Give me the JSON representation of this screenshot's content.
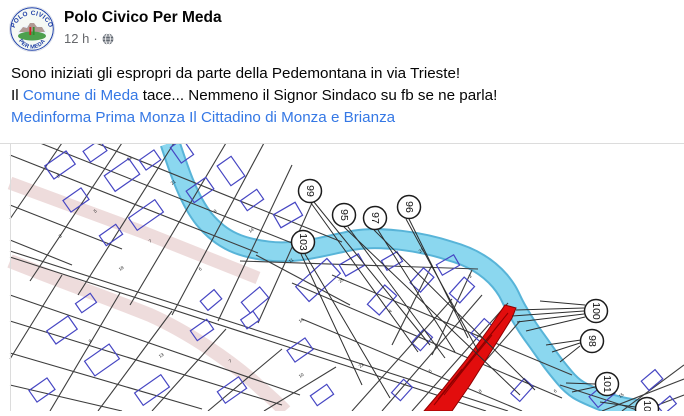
{
  "colors": {
    "text": "#050505",
    "secondary_text": "#65676b",
    "link": "#3578e5",
    "river": "#8bd7ef",
    "river_edge": "#58b4d8",
    "road": "#eedcdc",
    "parcel_line": "#3d3d3d",
    "building": "#4646c3",
    "red_zone": "#e20d0d",
    "red_zone_dark": "#8f0000",
    "marker_stroke": "#1c1c1c",
    "image_border": "#dcdcdc"
  },
  "post": {
    "author": "Polo Civico Per Meda",
    "avatar": {
      "top_text": "POLO CIVICO",
      "bottom_text": "PER MEDA"
    },
    "meta": {
      "time": "12 h",
      "sep": "·",
      "privacy": "globe"
    },
    "body": [
      [
        {
          "t": "Sono iniziati gli espropri da parte della Pedemontana in via Trieste!",
          "link": false
        }
      ],
      [
        {
          "t": "Il ",
          "link": false
        },
        {
          "t": "Comune di Meda",
          "link": true
        },
        {
          "t": " tace... Nemmeno il Signor Sindaco su fb se ne parla!",
          "link": false
        }
      ],
      [
        {
          "t": "Medinforma",
          "link": true
        },
        {
          "t": " ",
          "link": false
        },
        {
          "t": "Prima Monza",
          "link": true
        },
        {
          "t": " ",
          "link": false
        },
        {
          "t": "Il Cittadino di Monza e Brianza",
          "link": true
        }
      ]
    ]
  },
  "map": {
    "river": {
      "d": "M170,0 C178,24 188,56 204,76 C222,98 242,105 268,108 C300,112 330,101 355,97 C380,93 420,98 450,108 C472,114 488,124 500,138 C510,150 510,155 517,167 C528,186 530,188 540,202 C552,219 554,222 565,235 C576,248 584,250 600,257 C620,265 635,266 648,268"
    },
    "roads": [
      {
        "d": "M10,40 L140,88 L258,135",
        "w": 13
      },
      {
        "d": "M10,118 C60,138 110,156 150,172 C190,190 230,218 255,240 C268,252 278,260 285,268",
        "w": 14
      }
    ],
    "parcel_lines": [
      "M10,12 L258,110",
      "M40,0 L302,104",
      "M96,0 L342,99",
      "M10,62 L122,106",
      "M10,97 L72,122",
      "M122,0 L30,138",
      "M174,0 L78,152",
      "M226,0 L130,162",
      "M264,0 L172,172",
      "M62,0 L10,76",
      "M292,22 L218,178",
      "M320,42 L258,180",
      "M10,108 L508,268",
      "M10,114 L486,268",
      "M10,152 L300,252",
      "M10,178 L282,262",
      "M10,210 L202,266",
      "M10,242 L122,268",
      "M62,132 L10,216",
      "M120,150 L50,268",
      "M172,168 L98,268",
      "M226,186 L152,268",
      "M282,206 L208,268",
      "M336,224 L264,268",
      "M382,268 L482,152",
      "M352,268 L452,156",
      "M412,268 L508,160",
      "M442,268 L520,178",
      "M292,140 L562,255",
      "M302,176 L522,268",
      "M332,132 L572,232",
      "M256,112 L350,162",
      "M432,122 L392,202",
      "M472,127 L432,212",
      "M240,118 L478,126",
      "M622,268 L684,222",
      "M602,268 L684,236",
      "M642,268 L684,252",
      "M560,242 L640,268"
    ],
    "buildings": [
      [
        60,
        22,
        26,
        16,
        -35
      ],
      [
        95,
        8,
        20,
        13,
        -35
      ],
      [
        122,
        32,
        30,
        19,
        -35
      ],
      [
        76,
        57,
        22,
        14,
        -35
      ],
      [
        150,
        17,
        18,
        12,
        -35
      ],
      [
        182,
        8,
        15,
        19,
        -35
      ],
      [
        146,
        72,
        32,
        15,
        -35
      ],
      [
        111,
        92,
        20,
        12,
        -35
      ],
      [
        200,
        47,
        24,
        14,
        -35
      ],
      [
        231,
        28,
        17,
        24,
        -35
      ],
      [
        252,
        57,
        20,
        12,
        -35
      ],
      [
        288,
        72,
        25,
        15,
        -30
      ],
      [
        255,
        157,
        24,
        14,
        -40
      ],
      [
        211,
        157,
        18,
        12,
        -40
      ],
      [
        318,
        137,
        42,
        20,
        -42
      ],
      [
        86,
        160,
        18,
        11,
        -35
      ],
      [
        62,
        187,
        26,
        16,
        -35
      ],
      [
        102,
        217,
        30,
        18,
        -35
      ],
      [
        42,
        247,
        22,
        14,
        -35
      ],
      [
        152,
        247,
        32,
        15,
        -35
      ],
      [
        202,
        187,
        20,
        12,
        -35
      ],
      [
        250,
        177,
        15,
        11,
        -35
      ],
      [
        300,
        207,
        22,
        14,
        -35
      ],
      [
        232,
        247,
        26,
        14,
        -35
      ],
      [
        322,
        252,
        20,
        12,
        -35
      ],
      [
        382,
        157,
        26,
        16,
        -48
      ],
      [
        422,
        137,
        20,
        14,
        -48
      ],
      [
        462,
        147,
        22,
        14,
        -48
      ],
      [
        482,
        187,
        20,
        12,
        -48
      ],
      [
        422,
        197,
        18,
        12,
        -48
      ],
      [
        462,
        237,
        24,
        14,
        -48
      ],
      [
        402,
        247,
        18,
        12,
        -48
      ],
      [
        522,
        247,
        20,
        12,
        -48
      ],
      [
        352,
        122,
        22,
        13,
        -30
      ],
      [
        392,
        118,
        18,
        11,
        -30
      ],
      [
        448,
        122,
        20,
        12,
        -30
      ],
      [
        602,
        252,
        22,
        14,
        -40
      ],
      [
        652,
        237,
        18,
        12,
        -40
      ],
      [
        667,
        262,
        16,
        10,
        -40
      ]
    ],
    "red_zone": {
      "points": "424,268 452,268 470,242 492,207 512,175 516,165 505,162 488,187 466,217 442,247",
      "hatch": [
        "M434,262 L508,170",
        "M444,252 L472,216",
        "M456,236 L492,192",
        "M466,222 L500,180",
        "M438,256 L462,226"
      ]
    },
    "leaders": [
      [
        314,
        59,
        430,
        202
      ],
      [
        311,
        60,
        418,
        209
      ],
      [
        348,
        84,
        445,
        215
      ],
      [
        344,
        84,
        520,
        252
      ],
      [
        378,
        87,
        455,
        209
      ],
      [
        374,
        87,
        535,
        247
      ],
      [
        409,
        76,
        468,
        195
      ],
      [
        406,
        76,
        478,
        208
      ],
      [
        305,
        111,
        390,
        255
      ],
      [
        301,
        111,
        362,
        242
      ],
      [
        584,
        165,
        516,
        167
      ],
      [
        584,
        168,
        512,
        173
      ],
      [
        584,
        171,
        517,
        179
      ],
      [
        585,
        174,
        526,
        188
      ],
      [
        585,
        162,
        540,
        158
      ],
      [
        580,
        200,
        552,
        209
      ],
      [
        580,
        203,
        560,
        219
      ],
      [
        581,
        197,
        546,
        202
      ],
      [
        595,
        241,
        566,
        240
      ],
      [
        595,
        244,
        572,
        249
      ],
      [
        635,
        264,
        600,
        259
      ]
    ],
    "markers": [
      {
        "label": "99",
        "x": 310,
        "y": 48
      },
      {
        "label": "95",
        "x": 344,
        "y": 72
      },
      {
        "label": "97",
        "x": 375,
        "y": 75
      },
      {
        "label": "96",
        "x": 409,
        "y": 64
      },
      {
        "label": "103",
        "x": 303,
        "y": 99
      },
      {
        "label": "100",
        "x": 596,
        "y": 168
      },
      {
        "label": "98",
        "x": 592,
        "y": 198
      },
      {
        "label": "101",
        "x": 607,
        "y": 241
      },
      {
        "label": "102",
        "x": 647,
        "y": 266
      }
    ],
    "specks": [
      [
        58,
        35,
        "8"
      ],
      [
        128,
        18,
        "12"
      ],
      [
        95,
        70,
        "5"
      ],
      [
        172,
        42,
        "21"
      ],
      [
        215,
        70,
        "9"
      ],
      [
        250,
        90,
        "14"
      ],
      [
        150,
        100,
        "7"
      ],
      [
        60,
        95,
        "3"
      ],
      [
        120,
        128,
        "18"
      ],
      [
        200,
        128,
        "6"
      ],
      [
        290,
        120,
        "11"
      ],
      [
        340,
        140,
        "25"
      ],
      [
        390,
        170,
        "4"
      ],
      [
        300,
        180,
        "16"
      ],
      [
        90,
        200,
        "9"
      ],
      [
        160,
        215,
        "13"
      ],
      [
        230,
        220,
        "7"
      ],
      [
        300,
        235,
        "10"
      ],
      [
        360,
        225,
        "22"
      ],
      [
        430,
        230,
        "5"
      ],
      [
        480,
        250,
        "8"
      ],
      [
        555,
        250,
        "6"
      ],
      [
        620,
        255,
        "15"
      ],
      [
        420,
        110,
        "31"
      ],
      [
        470,
        135,
        "2"
      ]
    ]
  }
}
